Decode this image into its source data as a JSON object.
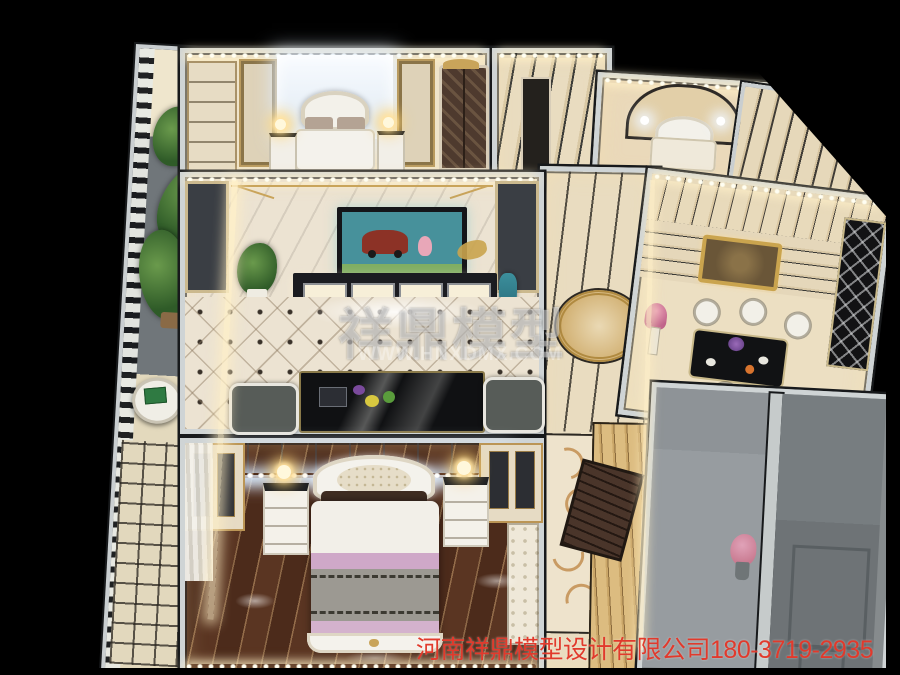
{
  "watermark": {
    "title": "祥鼎模型",
    "url": "WWW.HNXDMX.COM"
  },
  "footer": {
    "company": "河南祥鼎模型设计有限公司",
    "phone": "180-3719-2935"
  },
  "colors": {
    "background": "#000000",
    "wall_white": "#cfd4d5",
    "wall_cap": "#17191b",
    "led_warm": "#ffe9b0",
    "led_cool": "#e8f3ff",
    "floor_cream": "#efe4cb",
    "floor_marble": "#ece3d2",
    "floor_stripe": "#e8dabb",
    "floor_wood_dark": "#53301f",
    "floor_gray": "#868b8d",
    "balcony_gray": "#70767a",
    "plant_green": "#3f6b34",
    "gold_trim": "#c9a45a",
    "tv_screen_teal": "#47919b",
    "tv_car_red": "#8c3226",
    "bed_lavender": "#cfa8c8",
    "bed_gray": "#9c9992",
    "pillow_brown": "#3f2d22",
    "watermark_white": "rgba(255,255,255,0.42)",
    "footer_red": "#e13a2c"
  }
}
